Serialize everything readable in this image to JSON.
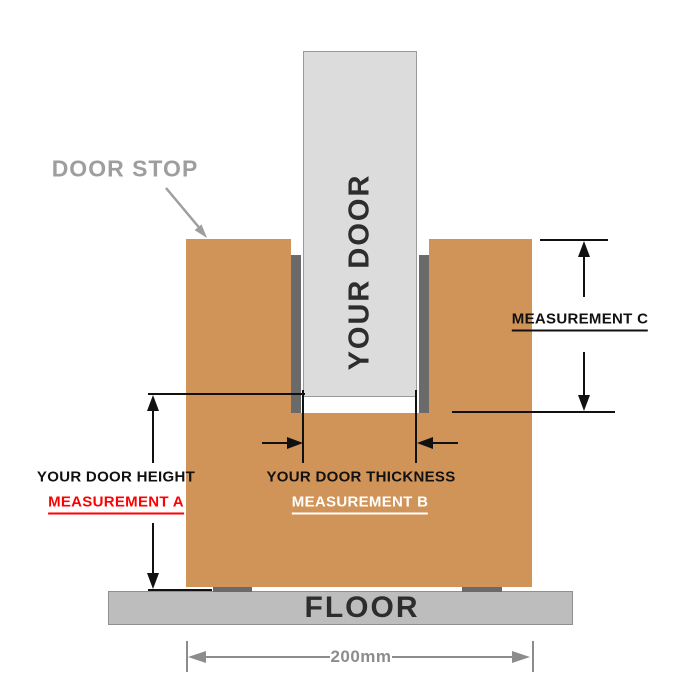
{
  "colors": {
    "background": "#ffffff",
    "frame": "#d09358",
    "stop": "#6a6a6a",
    "door-fill": "#dcdcdc",
    "door-border": "#9b9b9b",
    "floor-fill": "#bdbdbd",
    "floor-border": "#8f8f8f",
    "ink": "#111111",
    "text-dark": "#2d2d2d",
    "callout": "#9e9e9e",
    "dim": "#8c8c8c",
    "red": "#ff0000",
    "white-label": "#ffffff"
  },
  "door": {
    "label": "YOUR DOOR"
  },
  "door_stop": {
    "label": "DOOR STOP"
  },
  "floor": {
    "label": "FLOOR"
  },
  "measurement_a": {
    "title": "YOUR DOOR HEIGHT",
    "label": "MEASUREMENT A"
  },
  "measurement_b": {
    "title": "YOUR DOOR THICKNESS",
    "label": "MEASUREMENT B"
  },
  "measurement_c": {
    "label": "MEASUREMENT C"
  },
  "bottom_dimension": {
    "label": "200mm"
  }
}
